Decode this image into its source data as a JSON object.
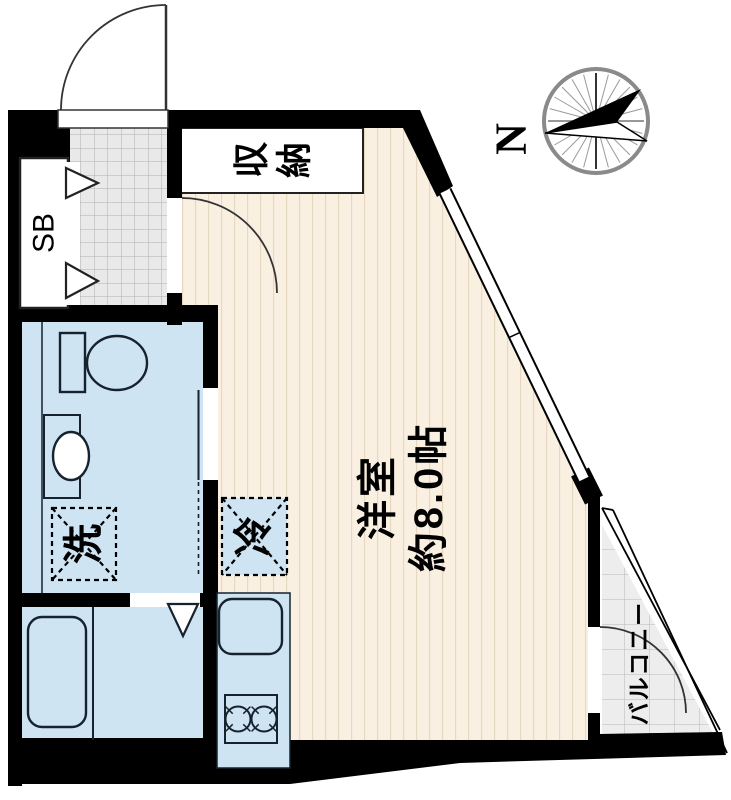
{
  "floorplan": {
    "main_room": {
      "name": "洋室",
      "size": "約8.0帖"
    },
    "storage_chars": [
      "収",
      "納"
    ],
    "shoe_box": "SB",
    "washer": "洗",
    "fridge": "冷",
    "balcony": "バルコニー",
    "north": "N",
    "colors": {
      "floor": "#faf0e2",
      "floor_stripe": "#e7d8c2",
      "wet_area": "#cee4f2",
      "tile": "#e9e9e9",
      "tile_line": "#b0b0b0",
      "wall": "#000000",
      "storage_fill": "#ffffff"
    }
  }
}
